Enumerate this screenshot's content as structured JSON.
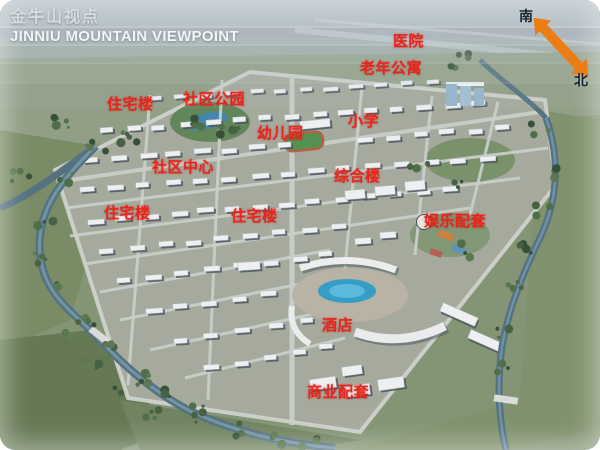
{
  "header": {
    "title_cn": "金牛山视点",
    "title_en": "JINNIU MOUNTAIN VIEWPOINT"
  },
  "compass": {
    "south": "南",
    "north": "北",
    "arrow_color": "#ec7d15"
  },
  "map": {
    "label_color": "#e8241c",
    "labels": [
      {
        "text": "医院",
        "x": 393,
        "y": 30
      },
      {
        "text": "老年公寓",
        "x": 360,
        "y": 57
      },
      {
        "text": "社区公园",
        "x": 183,
        "y": 88
      },
      {
        "text": "住宅楼",
        "x": 107,
        "y": 93
      },
      {
        "text": "小学",
        "x": 348,
        "y": 110
      },
      {
        "text": "幼儿园",
        "x": 257,
        "y": 122
      },
      {
        "text": "社区中心",
        "x": 152,
        "y": 156
      },
      {
        "text": "综合楼",
        "x": 334,
        "y": 165
      },
      {
        "text": "住宅楼",
        "x": 104,
        "y": 202
      },
      {
        "text": "住宅楼",
        "x": 231,
        "y": 205
      },
      {
        "text": "娱乐配套",
        "x": 424,
        "y": 210
      },
      {
        "text": "酒店",
        "x": 322,
        "y": 314
      },
      {
        "text": "商业配套",
        "x": 307,
        "y": 381
      }
    ]
  }
}
